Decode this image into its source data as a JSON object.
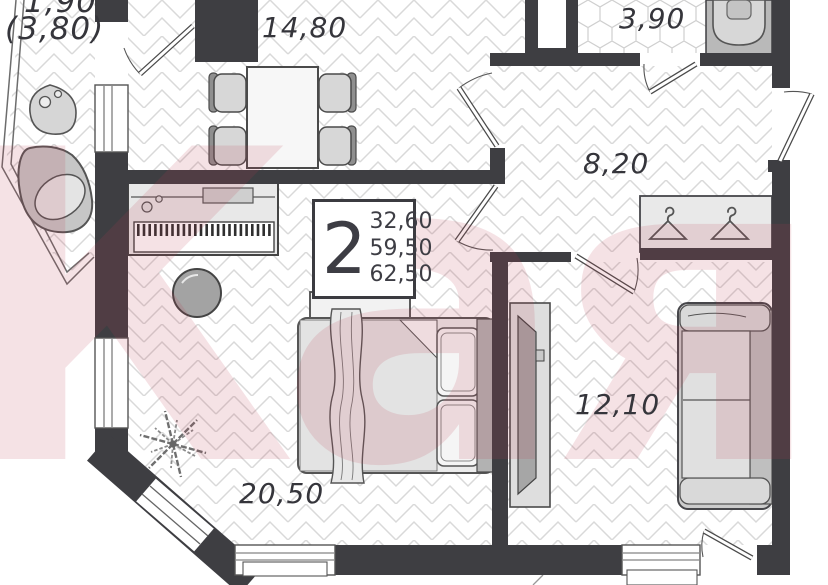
{
  "plan": {
    "watermark_text": "Каян",
    "rooms": {
      "balcony": {
        "area_main": "1,90",
        "area_alt": "(3,80)"
      },
      "kitchen_living": {
        "area": "14,80"
      },
      "bathroom": {
        "area": "3,90"
      },
      "hallway": {
        "area": "8,20"
      },
      "living_room": {
        "area": "20,50"
      },
      "bedroom": {
        "area": "12,10"
      }
    },
    "legend": {
      "rooms_count": "2",
      "living_area": "32,60",
      "floor_area": "59,50",
      "total_area": "62,50"
    },
    "colors": {
      "wall": "#3e3e42",
      "floor_line": "#d9d9d9",
      "tile_line": "#cfcfcf",
      "furniture_outline": "#4a4a4a",
      "watermark": "#ba3e50"
    }
  }
}
